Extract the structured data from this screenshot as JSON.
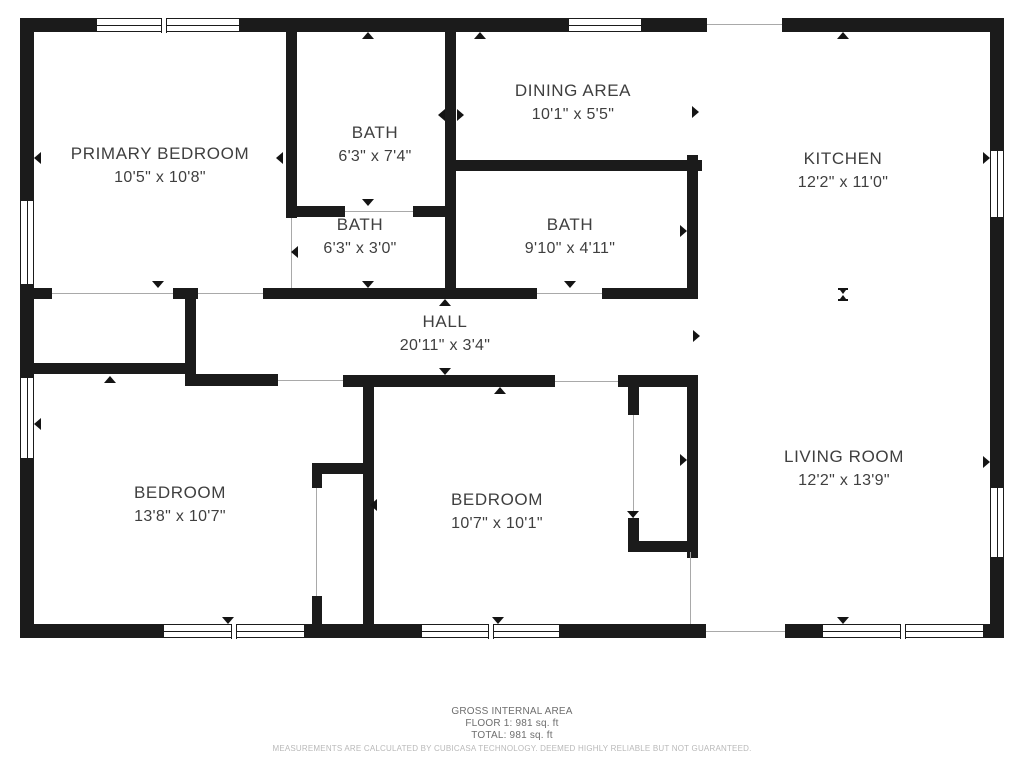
{
  "plan": {
    "rooms": [
      {
        "name": "PRIMARY BEDROOM",
        "dims": "10'5\" x 10'8\""
      },
      {
        "name": "BATH",
        "dims": "6'3\" x 7'4\""
      },
      {
        "name": "DINING AREA",
        "dims": "10'1\" x 5'5\""
      },
      {
        "name": "KITCHEN",
        "dims": "12'2\" x 11'0\""
      },
      {
        "name": "BATH",
        "dims": "6'3\" x 3'0\""
      },
      {
        "name": "BATH",
        "dims": "9'10\" x 4'11\""
      },
      {
        "name": "HALL",
        "dims": "20'11\" x 3'4\""
      },
      {
        "name": "BEDROOM",
        "dims": "13'8\" x 10'7\""
      },
      {
        "name": "BEDROOM",
        "dims": "10'7\" x 10'1\""
      },
      {
        "name": "LIVING ROOM",
        "dims": "12'2\" x 13'9\""
      }
    ],
    "footer": {
      "area_title": "GROSS INTERNAL AREA",
      "floor_line": "FLOOR 1: 981 sq. ft",
      "total_line": "TOTAL: 981 sq. ft",
      "disclaimer": "MEASUREMENTS ARE CALCULATED BY CUBICASA TECHNOLOGY. DEEMED HIGHLY RELIABLE BUT NOT GUARANTEED."
    },
    "colors": {
      "wall": "#1b1b1b",
      "label_text": "#3f3f3f",
      "footer_text": "#6e6e6e",
      "disclaimer_text": "#b9b9b9",
      "background": "#ffffff"
    },
    "icons": {
      "opening_marker": "triangle-icon",
      "open_boundary_marker": "hourglass-icon"
    }
  }
}
